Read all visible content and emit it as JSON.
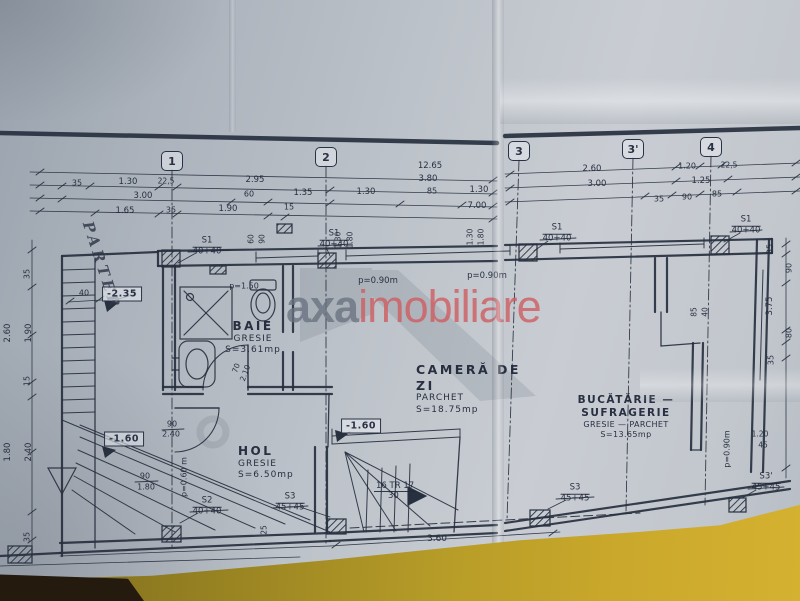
{
  "handwritten_note": "PARTER",
  "watermark": {
    "text_gray": "axa",
    "text_red": "imobiliare",
    "color_gray": "#68727f",
    "color_red": "#ce5c60"
  },
  "ink_color": "#27303f",
  "grid_axes": [
    {
      "label": "1",
      "x": 172,
      "y": 161
    },
    {
      "label": "2",
      "x": 326,
      "y": 157
    },
    {
      "label": "3",
      "x": 519,
      "y": 151
    },
    {
      "label": "3'",
      "x": 633,
      "y": 149
    },
    {
      "label": "4",
      "x": 711,
      "y": 147
    }
  ],
  "rooms": {
    "baie": {
      "name": "BAIE",
      "finish": "GRESIE",
      "area": "S=3.61mp"
    },
    "camera_de_zi": {
      "name": "CAMERĂ DE ZI",
      "finish": "PARCHET",
      "area": "S=18.75mp"
    },
    "bucatarie": {
      "name_line1": "BUCĂTĂRIE —",
      "name_line2": "SUFRAGERIE",
      "finish": "GRESIE — PARCHET",
      "area": "S=13.65mp"
    },
    "hol": {
      "name": "HOL",
      "finish": "GRESIE",
      "area": "S=6.50mp"
    }
  },
  "stairs": {
    "top": "16 TR 17",
    "bottom": "30"
  },
  "level_markers": [
    {
      "text": "-2.35",
      "x": 122,
      "y": 294
    },
    {
      "text": "-1.60",
      "x": 124,
      "y": 439
    },
    {
      "text": "-1.60",
      "x": 361,
      "y": 426
    }
  ],
  "column_labels": [
    {
      "name": "S1",
      "size": "40+40",
      "x": 207,
      "y": 247
    },
    {
      "name": "S1",
      "size": "40+40",
      "x": 334,
      "y": 240
    },
    {
      "name": "S1",
      "size": "40+40",
      "x": 557,
      "y": 234
    },
    {
      "name": "S1",
      "size": "40+40",
      "x": 746,
      "y": 226
    },
    {
      "name": "S2",
      "size": "40+40",
      "x": 207,
      "y": 507
    },
    {
      "name": "S3",
      "size": "45+45",
      "x": 290,
      "y": 503
    },
    {
      "name": "S3",
      "size": "45+45",
      "x": 575,
      "y": 494
    },
    {
      "name": "S3'",
      "size": "45+45",
      "x": 766,
      "y": 483
    }
  ],
  "dimensions": [
    {
      "t": "12.65",
      "x": 430,
      "y": 166
    },
    {
      "t": "3.80",
      "x": 428,
      "y": 179
    },
    {
      "t": "35",
      "x": 77,
      "y": 183,
      "s": 8
    },
    {
      "t": "1.30",
      "x": 128,
      "y": 182
    },
    {
      "t": "22,5",
      "x": 166,
      "y": 181,
      "s": 7.5
    },
    {
      "t": "2.95",
      "x": 255,
      "y": 180
    },
    {
      "t": "3.00",
      "x": 143,
      "y": 196
    },
    {
      "t": "60",
      "x": 249,
      "y": 194,
      "s": 8
    },
    {
      "t": "1.35",
      "x": 303,
      "y": 193
    },
    {
      "t": "1.30",
      "x": 366,
      "y": 192
    },
    {
      "t": "85",
      "x": 432,
      "y": 191,
      "s": 8
    },
    {
      "t": "1.30",
      "x": 479,
      "y": 190
    },
    {
      "t": "1.65",
      "x": 125,
      "y": 211
    },
    {
      "t": "35",
      "x": 171,
      "y": 210,
      "s": 8
    },
    {
      "t": "1.90",
      "x": 228,
      "y": 209
    },
    {
      "t": "15",
      "x": 289,
      "y": 207,
      "s": 8
    },
    {
      "t": "7.00",
      "x": 477,
      "y": 206
    },
    {
      "t": "2.60",
      "x": 592,
      "y": 169
    },
    {
      "t": "1.20",
      "x": 687,
      "y": 166,
      "s": 8
    },
    {
      "t": "22,5",
      "x": 729,
      "y": 165,
      "s": 7.5
    },
    {
      "t": "3.00",
      "x": 597,
      "y": 184
    },
    {
      "t": "1.25",
      "x": 701,
      "y": 181
    },
    {
      "t": "35",
      "x": 659,
      "y": 199,
      "s": 8
    },
    {
      "t": "90",
      "x": 687,
      "y": 197,
      "s": 8
    },
    {
      "t": "85",
      "x": 717,
      "y": 194,
      "s": 8
    },
    {
      "t": "35",
      "x": 27,
      "y": 274,
      "r": -90,
      "s": 8
    },
    {
      "t": "2.60",
      "x": 8,
      "y": 333,
      "r": -90
    },
    {
      "t": "1.90",
      "x": 29,
      "y": 333,
      "r": -90
    },
    {
      "t": "15",
      "x": 27,
      "y": 381,
      "r": -90,
      "s": 8
    },
    {
      "t": "1.80",
      "x": 8,
      "y": 452,
      "r": -90
    },
    {
      "t": "2.40",
      "x": 29,
      "y": 452,
      "r": -90
    },
    {
      "t": "35",
      "x": 27,
      "y": 537,
      "r": -90,
      "s": 8
    },
    {
      "t": "40",
      "x": 84,
      "y": 293,
      "s": 8
    },
    {
      "t": "60",
      "x": 251,
      "y": 239,
      "r": -90,
      "s": 7.5
    },
    {
      "t": "90",
      "x": 262,
      "y": 239,
      "r": -90,
      "s": 7.5
    },
    {
      "t": "1.30",
      "x": 338,
      "y": 240,
      "r": -90,
      "s": 7.5
    },
    {
      "t": "1.80",
      "x": 350,
      "y": 240,
      "r": -90,
      "s": 7.5
    },
    {
      "t": "1.30",
      "x": 470,
      "y": 237,
      "r": -90,
      "s": 7.5
    },
    {
      "t": "1.80",
      "x": 481,
      "y": 237,
      "r": -90,
      "s": 7.5
    },
    {
      "t": "85",
      "x": 694,
      "y": 312,
      "r": -90,
      "s": 7.5
    },
    {
      "t": "40",
      "x": 705,
      "y": 312,
      "r": -90,
      "s": 7.5
    },
    {
      "t": "35",
      "x": 770,
      "y": 249,
      "r": -90,
      "s": 8
    },
    {
      "t": "90",
      "x": 789,
      "y": 268,
      "r": -90,
      "s": 8
    },
    {
      "t": "3.75",
      "x": 770,
      "y": 306,
      "r": -90
    },
    {
      "t": "80",
      "x": 789,
      "y": 333,
      "r": -90,
      "s": 8
    },
    {
      "t": "35",
      "x": 771,
      "y": 360,
      "r": -90,
      "s": 8
    },
    {
      "t": "1.20",
      "x": 760,
      "y": 434,
      "s": 7.5
    },
    {
      "t": "45",
      "x": 763,
      "y": 445,
      "s": 7.5
    },
    {
      "t": "p=0.90m",
      "x": 727,
      "y": 449,
      "r": -90,
      "s": 8
    },
    {
      "t": "p=1.50",
      "x": 244,
      "y": 286,
      "s": 8
    },
    {
      "t": "p=0.90m",
      "x": 378,
      "y": 281
    },
    {
      "t": "p=0.90m",
      "x": 487,
      "y": 276
    },
    {
      "t": "p=0.60 m",
      "x": 184,
      "y": 477,
      "r": -90,
      "s": 8
    },
    {
      "t": "90",
      "x": 172,
      "y": 424,
      "s": 8
    },
    {
      "t": "2.40",
      "x": 171,
      "y": 434,
      "s": 8
    },
    {
      "t": "90",
      "x": 145,
      "y": 476,
      "s": 8
    },
    {
      "t": "1.80",
      "x": 146,
      "y": 487,
      "s": 8
    },
    {
      "t": "70",
      "x": 236,
      "y": 368,
      "r": -70,
      "s": 7.5
    },
    {
      "t": "2.10",
      "x": 245,
      "y": 373,
      "r": -70,
      "s": 7.5
    },
    {
      "t": "25",
      "x": 264,
      "y": 530,
      "r": -90,
      "s": 7.5
    },
    {
      "t": "3.60",
      "x": 437,
      "y": 539,
      "s": 9
    }
  ]
}
